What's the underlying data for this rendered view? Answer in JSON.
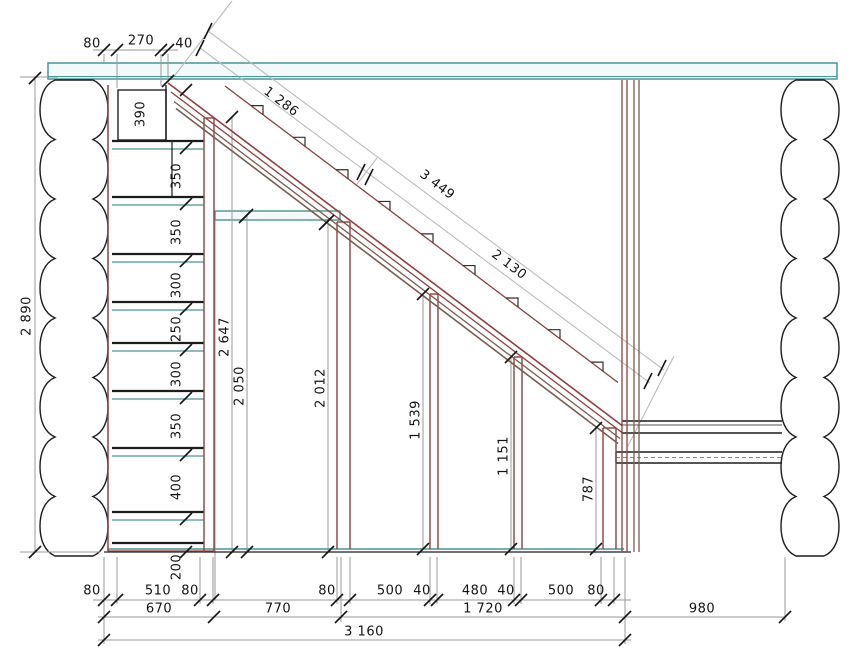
{
  "drawing": {
    "type": "staircase-section-technical-drawing",
    "units": "mm"
  },
  "colors": {
    "beam_teal": "#4d9494",
    "wood_red": "#8e4040",
    "wood_brown": "#7d5a4e",
    "dim_gray": "#999999",
    "dim_light": "#bcbcbc",
    "line_black": "#141414"
  },
  "dimensions": {
    "top_chain": [
      "80",
      "270",
      "40"
    ],
    "stringer_diagonal": [
      "1 286",
      "3 449",
      "2 130"
    ],
    "overall_height": "2 890",
    "step_heights": [
      "390",
      "350",
      "350",
      "300",
      "250",
      "300",
      "350",
      "400",
      "200"
    ],
    "interior_heights": [
      "2 647",
      "2 050",
      "2 012"
    ],
    "post_heights": [
      "1 539",
      "1 151",
      "787"
    ],
    "bottom_chain_left": [
      "80",
      "510",
      "80"
    ],
    "bottom_chain_right": [
      "80",
      "500",
      "40",
      "480",
      "40",
      "500",
      "80"
    ],
    "bottom_totals": [
      "670",
      "770",
      "1 720",
      "980",
      "3 160"
    ]
  },
  "labels": [
    {
      "name": "dim-top-80",
      "text": "80"
    },
    {
      "name": "dim-top-270",
      "text": "270"
    },
    {
      "name": "dim-top-40",
      "text": "40"
    },
    {
      "name": "dim-diag-1286",
      "text": "1 286"
    },
    {
      "name": "dim-diag-3449",
      "text": "3 449"
    },
    {
      "name": "dim-diag-2130",
      "text": "2 130"
    },
    {
      "name": "dim-overall-2890",
      "text": "2 890"
    },
    {
      "name": "dim-step-390",
      "text": "390"
    },
    {
      "name": "dim-step-350a",
      "text": "350"
    },
    {
      "name": "dim-step-350b",
      "text": "350"
    },
    {
      "name": "dim-step-300a",
      "text": "300"
    },
    {
      "name": "dim-step-250",
      "text": "250"
    },
    {
      "name": "dim-step-300b",
      "text": "300"
    },
    {
      "name": "dim-step-350c",
      "text": "350"
    },
    {
      "name": "dim-step-400",
      "text": "400"
    },
    {
      "name": "dim-step-200",
      "text": "200"
    },
    {
      "name": "dim-height-2647",
      "text": "2 647"
    },
    {
      "name": "dim-height-2050",
      "text": "2 050"
    },
    {
      "name": "dim-height-2012",
      "text": "2 012"
    },
    {
      "name": "dim-post-1539",
      "text": "1 539"
    },
    {
      "name": "dim-post-1151",
      "text": "1 151"
    },
    {
      "name": "dim-post-787",
      "text": "787"
    },
    {
      "name": "dim-bot-80a",
      "text": "80"
    },
    {
      "name": "dim-bot-510",
      "text": "510"
    },
    {
      "name": "dim-bot-80b",
      "text": "80"
    },
    {
      "name": "dim-bot-80c",
      "text": "80"
    },
    {
      "name": "dim-bot-500a",
      "text": "500"
    },
    {
      "name": "dim-bot-40a",
      "text": "40"
    },
    {
      "name": "dim-bot-480",
      "text": "480"
    },
    {
      "name": "dim-bot-40b",
      "text": "40"
    },
    {
      "name": "dim-bot-500b",
      "text": "500"
    },
    {
      "name": "dim-bot-80d",
      "text": "80"
    },
    {
      "name": "dim-total-670",
      "text": "670"
    },
    {
      "name": "dim-total-770",
      "text": "770"
    },
    {
      "name": "dim-total-1720",
      "text": "1 720"
    },
    {
      "name": "dim-total-980",
      "text": "980"
    },
    {
      "name": "dim-total-3160",
      "text": "3 160"
    }
  ]
}
